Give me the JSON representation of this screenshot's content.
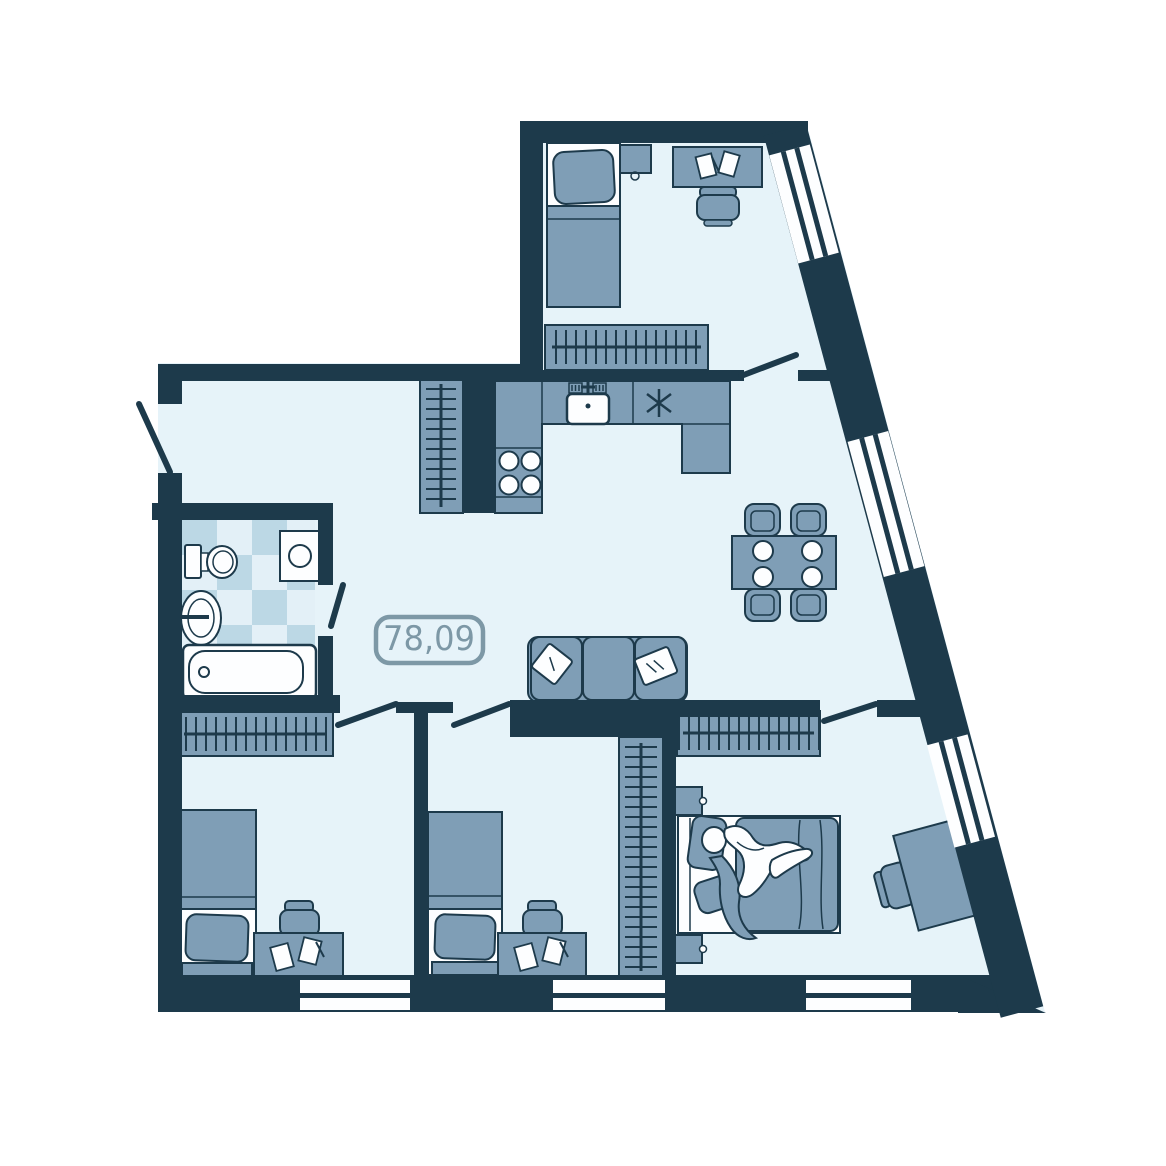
{
  "area_label": {
    "value": "78,09"
  },
  "colors": {
    "background": "#ffffff",
    "floor": "#e6f3f9",
    "wall": "#1d3a4b",
    "line": "#1d3a4b",
    "furn": "#7f9eb6",
    "furnsoft": "#8fafc4",
    "whiteitem": "#fdfeff",
    "tilea": "#bcd8e5",
    "tileb": "#e3f0f7",
    "label": "#7d98a6"
  },
  "inventory": {
    "objects": [
      "single-bed",
      "double-bed",
      "nightstand",
      "desk",
      "desk-chair",
      "wardrobe",
      "kitchen-counter",
      "kitchen-sink",
      "cooktop",
      "extractor-hood",
      "dining-table",
      "dining-chair",
      "plate",
      "sofa",
      "pillow",
      "toilet",
      "washing-machine",
      "bathroom-sink",
      "bathtub",
      "person",
      "window",
      "door-swing"
    ]
  }
}
